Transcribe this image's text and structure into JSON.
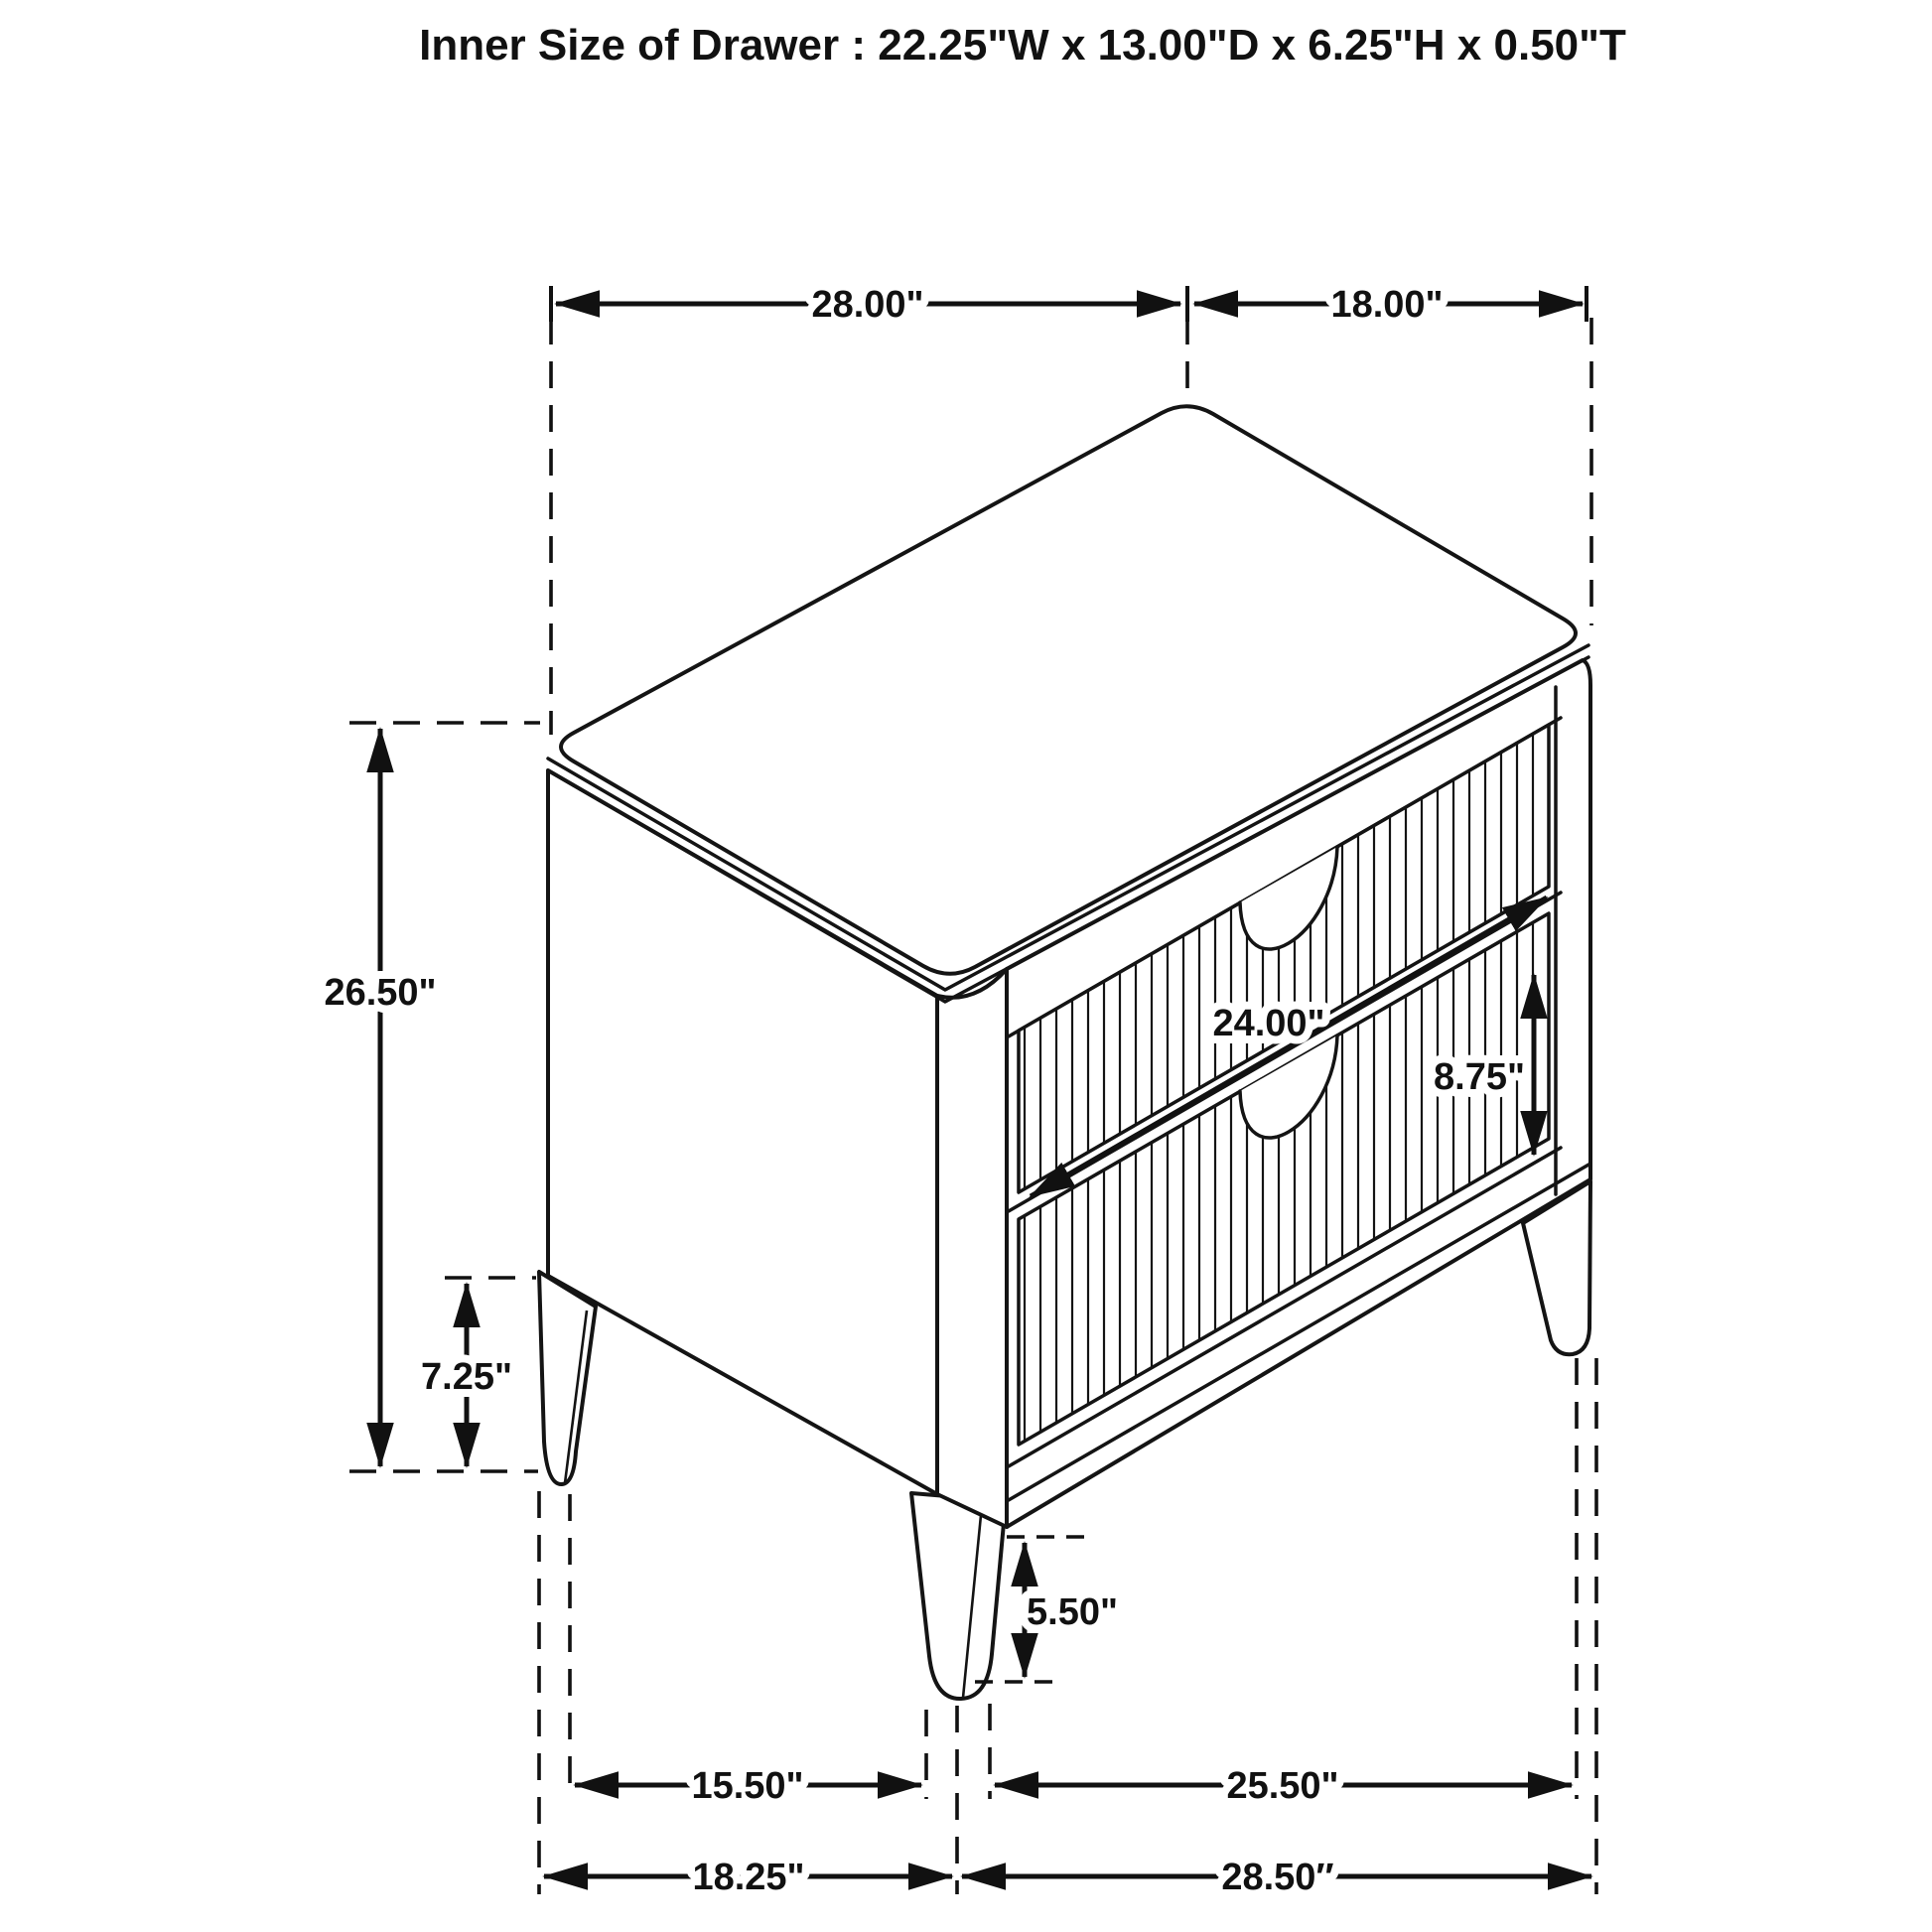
{
  "title": "Inner Size of Drawer : 22.25\"W x 13.00\"D x 6.25\"H x 0.50\"T",
  "labels": {
    "top_width": "28.00\"",
    "top_depth": "18.00\"",
    "overall_height": "26.50\"",
    "leg_height": "7.25\"",
    "drawer_width": "24.00\"",
    "drawer_front_height": "8.75\"",
    "front_leg_height": "5.50\"",
    "leg_span_side_inner": "15.50\"",
    "leg_span_front_inner": "25.50\"",
    "footprint_depth": "18.25\"",
    "footprint_width": "28.50″"
  },
  "colors": {
    "ink": "#111111",
    "background": "#ffffff"
  }
}
